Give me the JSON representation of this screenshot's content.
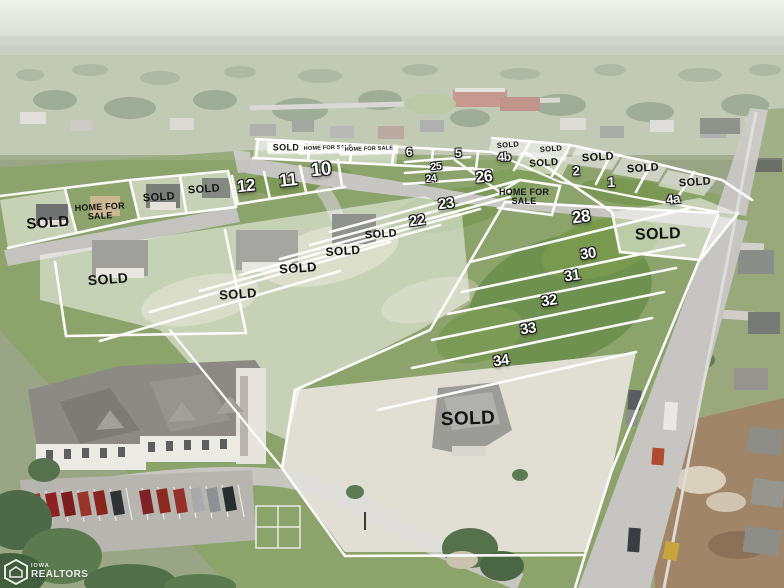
{
  "watermark": {
    "org_small": "IOWA",
    "org_large": "REALTORS"
  },
  "colors": {
    "lot_line": "#ffffff",
    "lot_number_fill": "#ffffff",
    "sold_text": "#141414",
    "wash": "rgba(255,255,255,0.5)"
  },
  "labels": {
    "lot_numbers": [
      {
        "text": "12",
        "x": 246,
        "y": 186,
        "size": 17,
        "rot": -6
      },
      {
        "text": "11",
        "x": 288,
        "y": 180,
        "size": 18,
        "rot": -6
      },
      {
        "text": "10",
        "x": 321,
        "y": 170,
        "size": 19,
        "rot": -6
      },
      {
        "text": "6",
        "x": 409,
        "y": 152,
        "size": 12,
        "rot": -3
      },
      {
        "text": "5",
        "x": 458,
        "y": 153,
        "size": 12,
        "rot": -3
      },
      {
        "text": "4b",
        "x": 504,
        "y": 157,
        "size": 12,
        "rot": -3
      },
      {
        "text": "25",
        "x": 436,
        "y": 167,
        "size": 10.5,
        "rot": -6
      },
      {
        "text": "24",
        "x": 431,
        "y": 179,
        "size": 10.5,
        "rot": -6
      },
      {
        "text": "26",
        "x": 484,
        "y": 178,
        "size": 16,
        "rot": -6
      },
      {
        "text": "2",
        "x": 576,
        "y": 171,
        "size": 13,
        "rot": -2
      },
      {
        "text": "1",
        "x": 611,
        "y": 182,
        "size": 14,
        "rot": -2
      },
      {
        "text": "4a",
        "x": 673,
        "y": 199,
        "size": 13,
        "rot": -6
      },
      {
        "text": "23",
        "x": 446,
        "y": 204,
        "size": 15,
        "rot": -8
      },
      {
        "text": "22",
        "x": 417,
        "y": 221,
        "size": 15,
        "rot": -8
      },
      {
        "text": "28",
        "x": 581,
        "y": 217,
        "size": 17,
        "rot": -8
      },
      {
        "text": "30",
        "x": 588,
        "y": 254,
        "size": 15,
        "rot": -8
      },
      {
        "text": "31",
        "x": 572,
        "y": 276,
        "size": 15,
        "rot": -8
      },
      {
        "text": "32",
        "x": 549,
        "y": 301,
        "size": 15,
        "rot": -8
      },
      {
        "text": "33",
        "x": 528,
        "y": 329,
        "size": 15,
        "rot": -8
      },
      {
        "text": "34",
        "x": 501,
        "y": 361,
        "size": 15,
        "rot": -8
      }
    ],
    "sold": [
      {
        "text": "SOLD",
        "x": 286,
        "y": 148,
        "size": 9,
        "rot": 0,
        "chip": true
      },
      {
        "text": "SOLD",
        "x": 508,
        "y": 145,
        "size": 7.5,
        "rot": -4
      },
      {
        "text": "SOLD",
        "x": 551,
        "y": 149,
        "size": 7.5,
        "rot": -4
      },
      {
        "text": "SOLD",
        "x": 544,
        "y": 164,
        "size": 10,
        "rot": -4
      },
      {
        "text": "SOLD",
        "x": 598,
        "y": 158,
        "size": 11,
        "rot": -4
      },
      {
        "text": "SOLD",
        "x": 643,
        "y": 169,
        "size": 11,
        "rot": -4
      },
      {
        "text": "SOLD",
        "x": 695,
        "y": 183,
        "size": 11,
        "rot": -4
      },
      {
        "text": "SOLD",
        "x": 658,
        "y": 235,
        "size": 16,
        "rot": -2
      },
      {
        "text": "SOLD",
        "x": 204,
        "y": 190,
        "size": 11,
        "rot": -4
      },
      {
        "text": "SOLD",
        "x": 159,
        "y": 198,
        "size": 11,
        "rot": -4
      },
      {
        "text": "SOLD",
        "x": 48,
        "y": 223,
        "size": 15,
        "rot": -4
      },
      {
        "text": "SOLD",
        "x": 381,
        "y": 235,
        "size": 11,
        "rot": -4
      },
      {
        "text": "SOLD",
        "x": 343,
        "y": 251,
        "size": 12,
        "rot": -4
      },
      {
        "text": "SOLD",
        "x": 298,
        "y": 268,
        "size": 13,
        "rot": -4
      },
      {
        "text": "SOLD",
        "x": 238,
        "y": 294,
        "size": 13,
        "rot": -4
      },
      {
        "text": "SOLD",
        "x": 108,
        "y": 279,
        "size": 14,
        "rot": -4
      },
      {
        "text": "SOLD",
        "x": 468,
        "y": 419,
        "size": 19,
        "rot": -2
      }
    ],
    "home_for_sale": [
      {
        "text": "HOME FOR SALE",
        "x": 100,
        "y": 212,
        "size": 9,
        "rot": -3,
        "wrap": true
      },
      {
        "text": "HOME FOR SALE",
        "x": 524,
        "y": 197,
        "size": 9,
        "rot": 0,
        "wrap": true
      },
      {
        "text": "HOME FOR SALE",
        "x": 328,
        "y": 149,
        "size": 5.5,
        "rot": -2,
        "chip": true
      },
      {
        "text": "HOME FOR SALE",
        "x": 369,
        "y": 150,
        "size": 5.5,
        "rot": -2,
        "chip": true
      }
    ]
  }
}
